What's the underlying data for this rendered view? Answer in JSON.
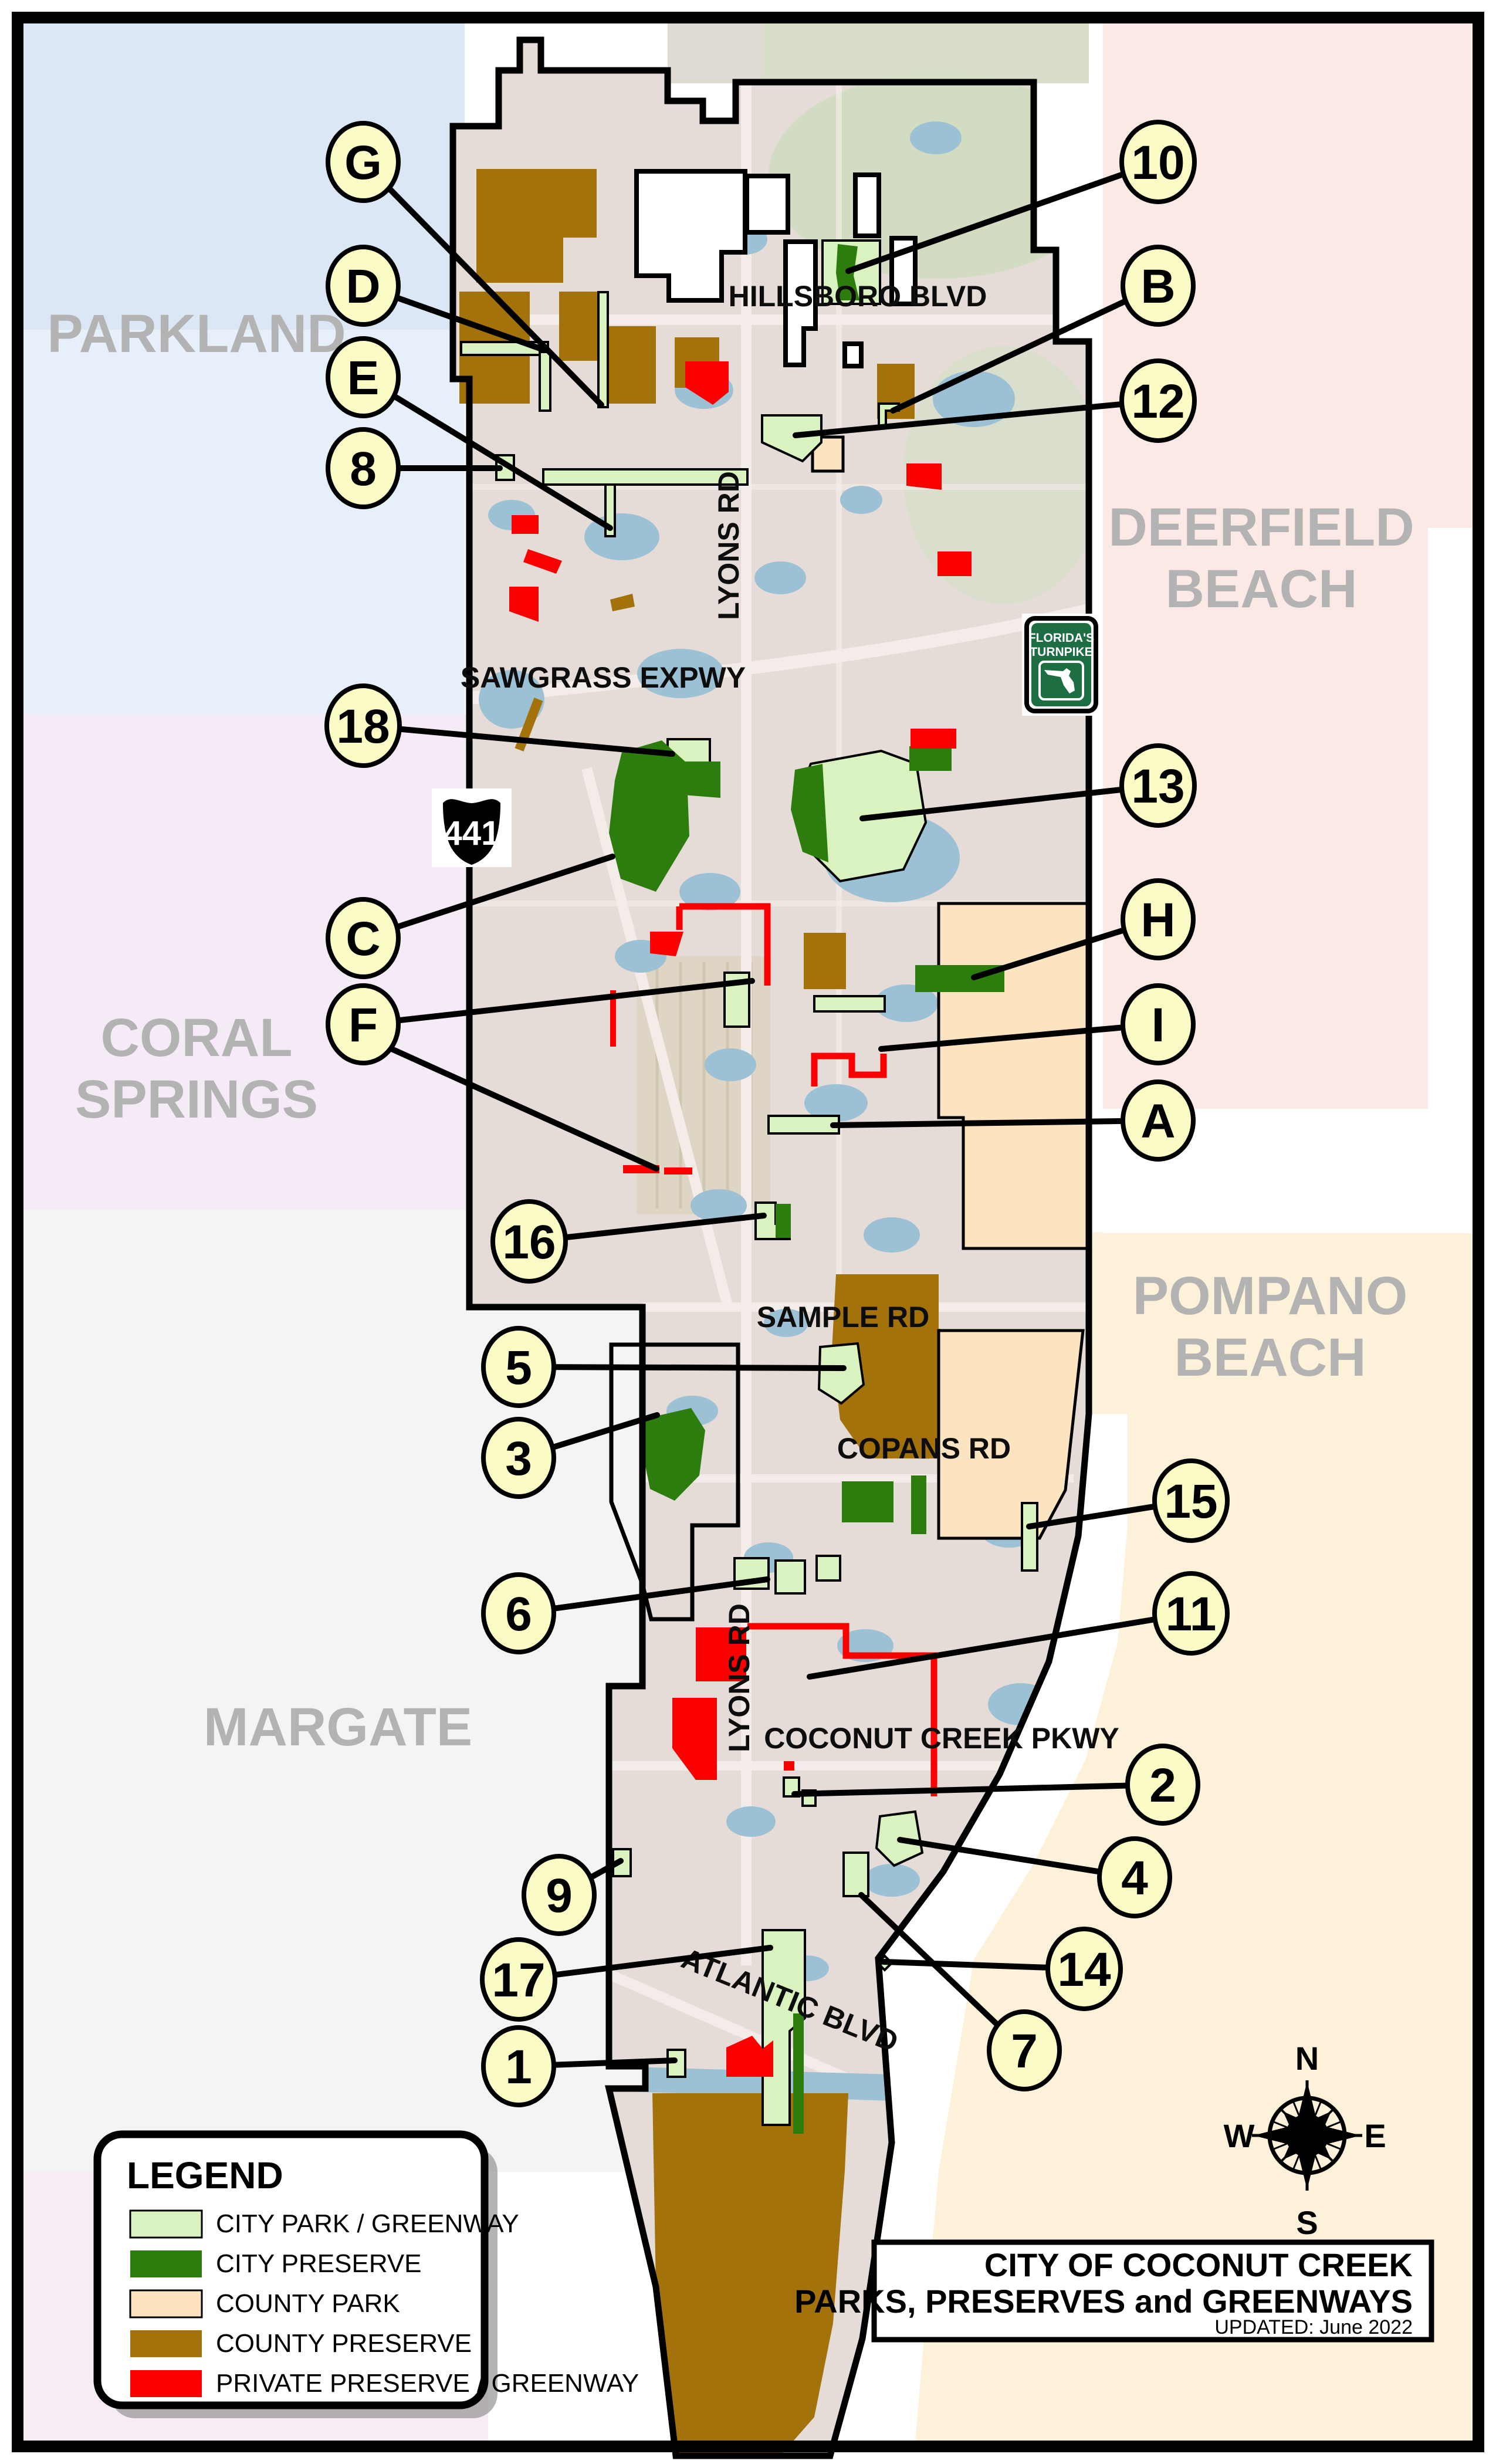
{
  "title_block": {
    "line1": "CITY OF COCONUT CREEK",
    "line2": "PARKS, PRESERVES and GREENWAYS",
    "updated": "UPDATED: June 2022"
  },
  "legend": {
    "title": "LEGEND",
    "items": [
      {
        "label": "CITY PARK / GREENWAY",
        "color": "#d9f2bf"
      },
      {
        "label": "CITY PRESERVE",
        "color": "#2d7d0e"
      },
      {
        "label": "COUNTY PARK",
        "color": "#fce4c1"
      },
      {
        "label": "COUNTY PRESERVE",
        "color": "#a3720a"
      },
      {
        "label": "PRIVATE PRESERVE / GREENWAY",
        "color": "#fb0000"
      }
    ]
  },
  "neighbors": {
    "parkland": "PARKLAND",
    "deerfield": [
      "DEERFIELD",
      "BEACH"
    ],
    "coral_springs": [
      "CORAL",
      "SPRINGS"
    ],
    "pompano": [
      "POMPANO",
      "BEACH"
    ],
    "margate": "MARGATE"
  },
  "roads": {
    "hillsboro": "HILLSBORO BLVD",
    "sawgrass": "SAWGRASS EXPWY",
    "lyons": "LYONS RD",
    "sample": "SAMPLE RD",
    "copans": "COPANS RD",
    "coconut_creek": "COCONUT CREEK PKWY",
    "atlantic": "ATLANTIC BLVD"
  },
  "shields": {
    "us441": "441",
    "turnpike": [
      "FLORIDA'S",
      "TURNPIKE"
    ]
  },
  "compass": {
    "n": "N",
    "e": "E",
    "s": "S",
    "w": "W"
  },
  "callouts": [
    {
      "label": "G"
    },
    {
      "label": "D"
    },
    {
      "label": "E"
    },
    {
      "label": "8"
    },
    {
      "label": "18"
    },
    {
      "label": "C"
    },
    {
      "label": "F"
    },
    {
      "label": "16"
    },
    {
      "label": "5"
    },
    {
      "label": "3"
    },
    {
      "label": "6"
    },
    {
      "label": "9"
    },
    {
      "label": "17"
    },
    {
      "label": "1"
    },
    {
      "label": "10"
    },
    {
      "label": "B"
    },
    {
      "label": "12"
    },
    {
      "label": "13"
    },
    {
      "label": "H"
    },
    {
      "label": "I"
    },
    {
      "label": "A"
    },
    {
      "label": "15"
    },
    {
      "label": "11"
    },
    {
      "label": "2"
    },
    {
      "label": "4"
    },
    {
      "label": "14"
    },
    {
      "label": "7"
    }
  ]
}
